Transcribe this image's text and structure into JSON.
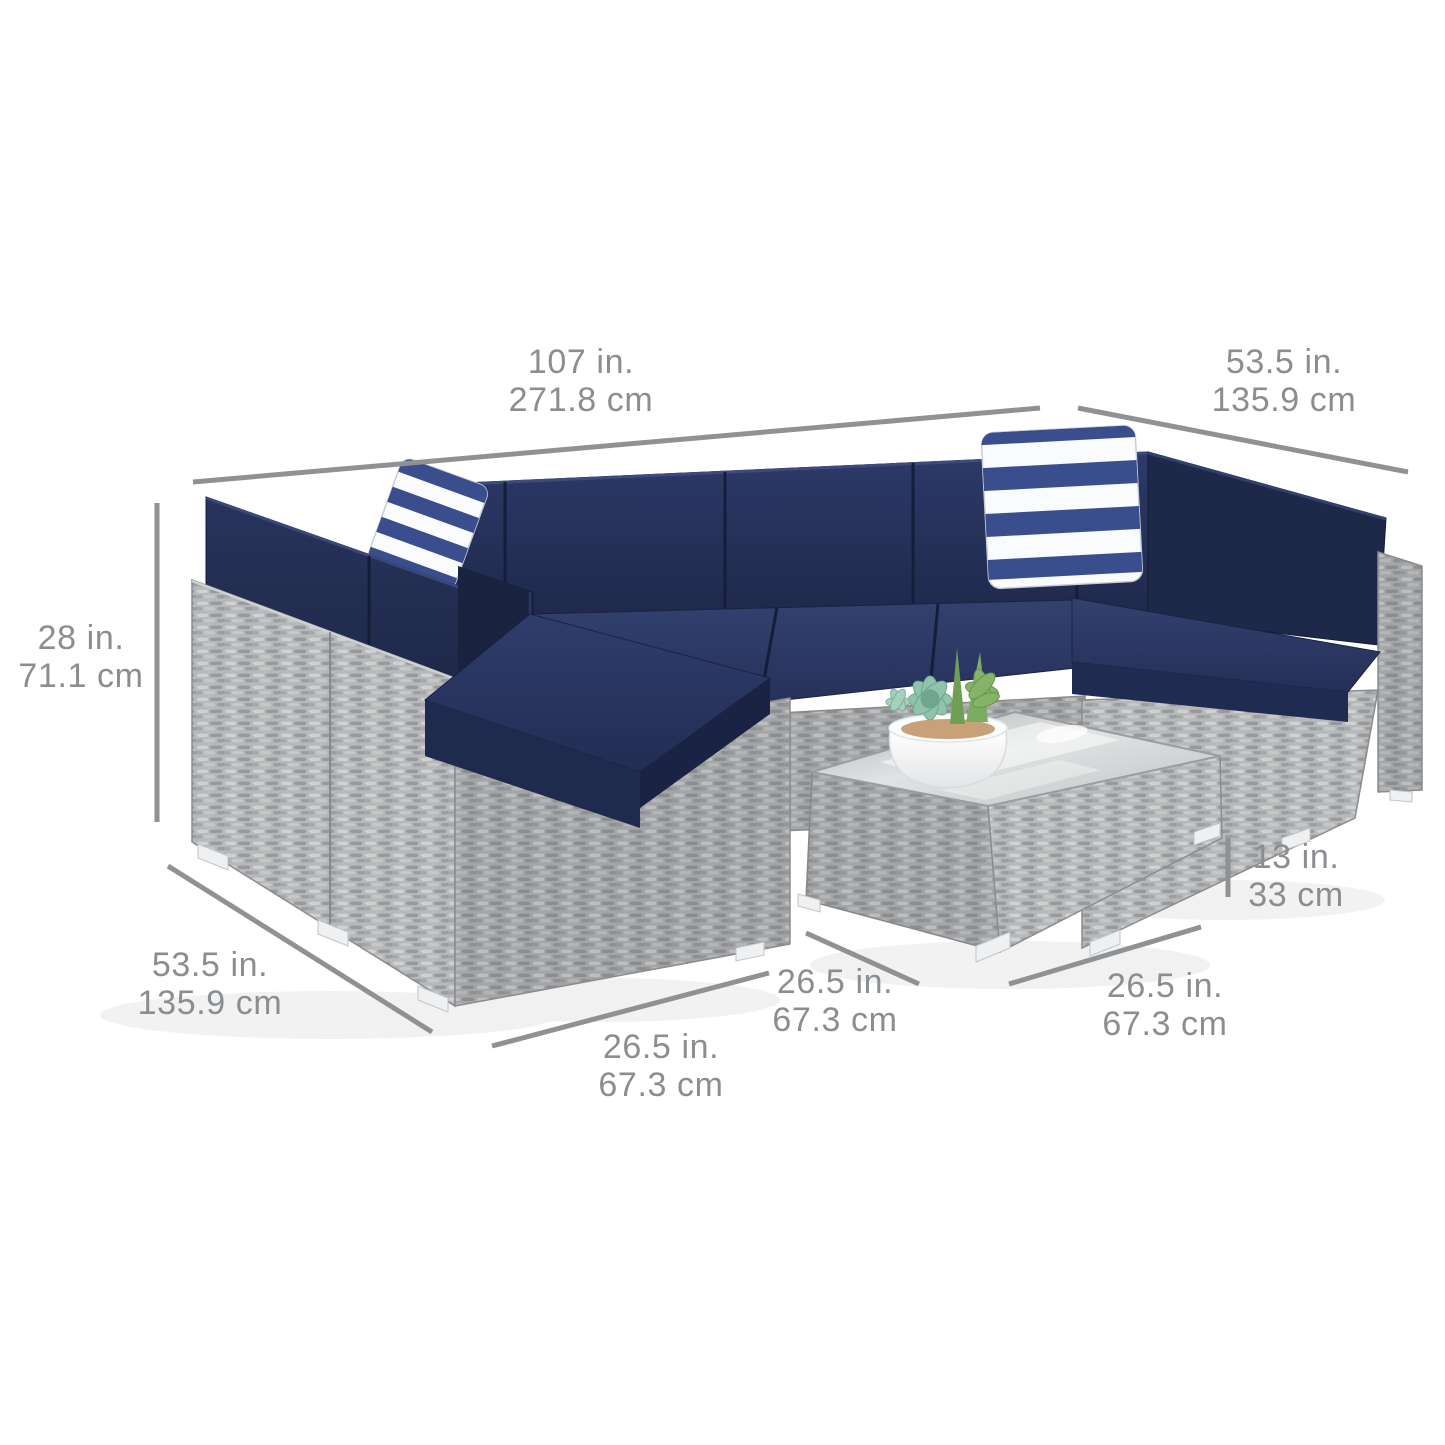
{
  "image": {
    "subject": "Outdoor wicker sectional sofa set with navy cushions, striped accent pillows and glass-top coffee table, shown with product dimensions"
  },
  "dimensions": {
    "sofa_width": {
      "inches": "107 in.",
      "cm": "271.8 cm"
    },
    "sofa_depth_right": {
      "inches": "53.5 in.",
      "cm": "135.9 cm"
    },
    "sofa_height": {
      "inches": "28 in.",
      "cm": "71.1 cm"
    },
    "sofa_depth_left": {
      "inches": "53.5 in.",
      "cm": "135.9 cm"
    },
    "seat_width": {
      "inches": "26.5 in.",
      "cm": "67.3 cm"
    },
    "table_depth": {
      "inches": "26.5 in.",
      "cm": "67.3 cm"
    },
    "table_width": {
      "inches": "26.5 in.",
      "cm": "67.3 cm"
    },
    "table_height": {
      "inches": "13 in.",
      "cm": "33 cm"
    }
  },
  "colors": {
    "background": "#ffffff",
    "dimension_line_gray": "#8f9295",
    "label_text_gray": "#8b8e91",
    "cushion_navy_dark": "#1c2546",
    "cushion_navy": "#273459",
    "cushion_navy_light": "#31406e",
    "pillow_stripe_navy": "#3a4e8e",
    "pillow_stripe_white": "#fafbfc",
    "wicker_gray": "#b6b8b9",
    "wicker_gray_shaded": "#a3a5a7",
    "glass_gray": "#c9cccd",
    "pot_white": "#ffffff",
    "succulent_teal": "#8fc4ab",
    "succulent_green": "#85b468",
    "feet_white": "#eef0f1"
  }
}
